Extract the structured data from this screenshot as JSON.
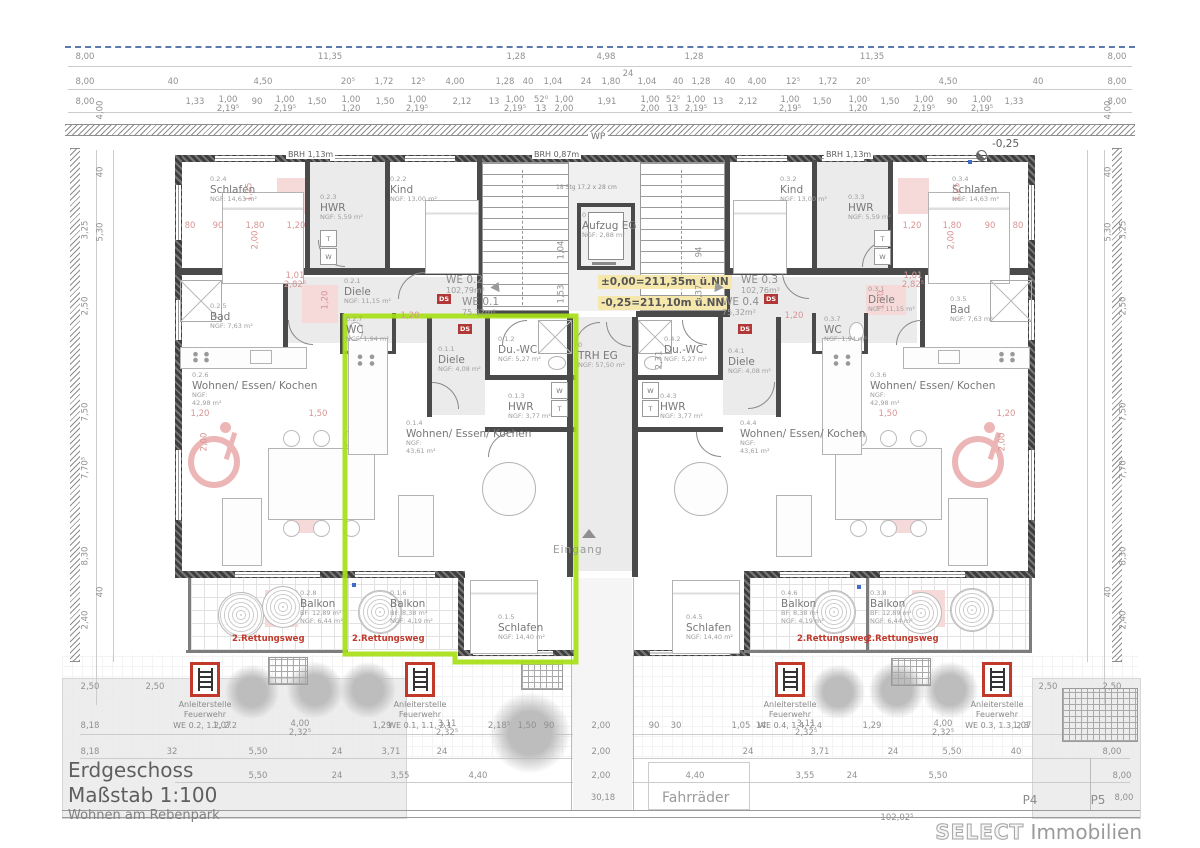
{
  "title": {
    "line1": "Erdgeschoss",
    "line2": "Maßstab 1:100",
    "line3": "Wohnen am Rebenpark"
  },
  "brand": {
    "name": "SELECT",
    "suffix": "Immobilien"
  },
  "labels": {
    "escape": "2.Rettungsweg",
    "ds": "DS",
    "wp": "WP",
    "brh_a": "BRH 1,13m",
    "brh_b": "BRH 0,87m",
    "brh_c": "BRH 1,13m",
    "eingang": "Eingang",
    "fahrraeder": "Fahrräder",
    "minus": "-0,25",
    "stair_note": "18 Stg 17,2 x 28 cm",
    "washer": "W",
    "dryer": "T"
  },
  "levels": {
    "l1": "±0,00=211,35m ü.NN",
    "l2": "-0,25=211,10m ü.NN"
  },
  "colors": {
    "highlight": "#a6e016",
    "escape_red": "#c0392b",
    "pink_fill": "#f6d9d9",
    "level_note_bg": "#f6e8ad",
    "property_line_blue": "#5b79ae"
  },
  "fire": {
    "l1": "Anleiterstelle",
    "l2": "Feuerwehr",
    "items": [
      {
        "we": "WE 0.2, 1.2, 2.2"
      },
      {
        "we": "WE 0.1, 1.1, 2.1"
      },
      {
        "we": "WE 0.4, 1.4, 2.4"
      },
      {
        "we": "WE 0.3, 1.3, 2.3"
      }
    ]
  },
  "units": [
    {
      "we": "WE 0.2",
      "area": "102,79m²",
      "x": 446,
      "y": 274
    },
    {
      "we": "WE 0.1",
      "area": "75,32m²",
      "x": 462,
      "y": 296
    },
    {
      "we": "WE 0.3",
      "area": "102,76m²",
      "x": 741,
      "y": 274
    },
    {
      "we": "WE 0.4",
      "area": "75,32m²",
      "x": 722,
      "y": 296
    }
  ],
  "rooms": [
    {
      "num": "0.2.4",
      "name": "Schlafen",
      "a": "NGF: 14,63 m²",
      "x": 210,
      "y": 176
    },
    {
      "num": "0.2.3",
      "name": "HWR",
      "a": "NGF: 5,59 m²",
      "x": 320,
      "y": 194
    },
    {
      "num": "0.2.2",
      "name": "Kind",
      "a": "NGF: 13,00 m²",
      "x": 390,
      "y": 176
    },
    {
      "num": "0.2.1",
      "name": "Diele",
      "a": "NGF: 11,15 m²",
      "x": 344,
      "y": 278
    },
    {
      "num": "0.2.5",
      "name": "Bad",
      "a": "NGF: 7,63 m²",
      "x": 210,
      "y": 303
    },
    {
      "num": "0.2.7",
      "name": "WC",
      "a": "NGF: 1,94 m²",
      "x": 346,
      "y": 316
    },
    {
      "num": "0.2.6",
      "name": "Wohnen/ Essen/ Kochen",
      "a": "NGF:",
      "a2": "42,98 m²",
      "x": 192,
      "y": 372
    },
    {
      "num": "0.2.8",
      "name": "Balkon",
      "a": "BF: 12,89 m²",
      "a2": "NGF: 6,44 m²",
      "x": 300,
      "y": 590
    },
    {
      "num": "0.1.1",
      "name": "Diele",
      "a": "NGF: 4,08 m²",
      "x": 438,
      "y": 346
    },
    {
      "num": "0.1.2",
      "name": "Du.-WC",
      "a": "NGF: 5,27 m²",
      "x": 498,
      "y": 336
    },
    {
      "num": "0.1.3",
      "name": "HWR",
      "a": "NGF: 3,77 m²",
      "x": 508,
      "y": 393
    },
    {
      "num": "0.1.4",
      "name": "Wohnen/ Essen/ Kochen",
      "a": "NGF:",
      "a2": "43,61 m²",
      "x": 406,
      "y": 420
    },
    {
      "num": "0.1.5",
      "name": "Schlafen",
      "a": "NGF: 14,40 m²",
      "x": 498,
      "y": 614
    },
    {
      "num": "0.1.6",
      "name": "Balkon",
      "a": "BF: 8,38 m²",
      "a2": "NGF: 4,19 m²",
      "x": 390,
      "y": 590
    },
    {
      "num": "0.4.1",
      "name": "Diele",
      "a": "NGF: 4,08 m²",
      "x": 728,
      "y": 348
    },
    {
      "num": "0.4.2",
      "name": "Du.-WC",
      "a": "NGF: 5,27 m²",
      "x": 664,
      "y": 336
    },
    {
      "num": "0.4.3",
      "name": "HWR",
      "a": "NGF: 3,77 m²",
      "x": 660,
      "y": 393
    },
    {
      "num": "0.4.4",
      "name": "Wohnen/ Essen/ Kochen",
      "a": "NGF:",
      "a2": "43,61 m²",
      "x": 740,
      "y": 420
    },
    {
      "num": "0.4.5",
      "name": "Schlafen",
      "a": "NGF: 14,40 m²",
      "x": 686,
      "y": 614
    },
    {
      "num": "0.4.6",
      "name": "Balkon",
      "a": "BF: 8,38 m²",
      "a2": "NGF: 4,19 m²",
      "x": 781,
      "y": 590
    },
    {
      "num": "0.3.2",
      "name": "Kind",
      "a": "NGF: 13,00 m²",
      "x": 780,
      "y": 176
    },
    {
      "num": "0.3.3",
      "name": "HWR",
      "a": "NGF: 5,59 m²",
      "x": 848,
      "y": 194
    },
    {
      "num": "0.3.4",
      "name": "Schlafen",
      "a": "NGF: 14,63 m²",
      "x": 952,
      "y": 176
    },
    {
      "num": "0.3.1",
      "name": "Diele",
      "a": "NGF: 11,15 m²",
      "x": 868,
      "y": 286
    },
    {
      "num": "0.3.5",
      "name": "Bad",
      "a": "NGF: 7,63 m²",
      "x": 950,
      "y": 296
    },
    {
      "num": "0.3.7",
      "name": "WC",
      "a": "NGF: 1,94 m²",
      "x": 824,
      "y": 316
    },
    {
      "num": "0.3.6",
      "name": "Wohnen/ Essen/ Kochen",
      "a": "NGF:",
      "a2": "42,98 m²",
      "x": 870,
      "y": 372
    },
    {
      "num": "0.3.8",
      "name": "Balkon",
      "a": "BF: 12,89 m²",
      "a2": "NGF: 6,44 m²",
      "x": 870,
      "y": 590
    },
    {
      "num": "0",
      "name": "Aufzug EG",
      "a": "NGF: 2,88 m²",
      "x": 582,
      "y": 212
    },
    {
      "num": "0",
      "name": "TRH EG",
      "a": "NGF: 57,50 m²",
      "x": 578,
      "y": 342
    }
  ],
  "dims": {
    "rows": [
      {
        "y": 53,
        "items": [
          {
            "t": "8,00",
            "x": 85
          },
          {
            "t": "11,35",
            "x": 330
          },
          {
            "t": "1,28",
            "x": 516
          },
          {
            "t": "4,98",
            "x": 606
          },
          {
            "t": "1,28",
            "x": 694
          },
          {
            "t": "11,35",
            "x": 872
          },
          {
            "t": "8,00",
            "x": 1117
          }
        ]
      },
      {
        "y": 70,
        "items": [
          {
            "t": "24",
            "x": 628
          }
        ]
      },
      {
        "y": 78,
        "items": [
          {
            "t": "8,00",
            "x": 85
          },
          {
            "t": "40",
            "x": 173
          },
          {
            "t": "4,50",
            "x": 263
          },
          {
            "t": "20⁵",
            "x": 348
          },
          {
            "t": "1,72",
            "x": 384
          },
          {
            "t": "12⁵",
            "x": 418
          },
          {
            "t": "4,00",
            "x": 455
          },
          {
            "t": "1,28",
            "x": 505
          },
          {
            "t": "40",
            "x": 528
          },
          {
            "t": "1,04",
            "x": 553
          },
          {
            "t": "24",
            "x": 586
          },
          {
            "t": "1,80",
            "x": 611
          },
          {
            "t": "1,04",
            "x": 647
          },
          {
            "t": "40",
            "x": 678
          },
          {
            "t": "1,28",
            "x": 701
          },
          {
            "t": "40",
            "x": 730
          },
          {
            "t": "4,00",
            "x": 757
          },
          {
            "t": "12⁵",
            "x": 793
          },
          {
            "t": "1,72",
            "x": 828
          },
          {
            "t": "20⁵",
            "x": 863
          },
          {
            "t": "4,50",
            "x": 948
          },
          {
            "t": "40",
            "x": 1038
          },
          {
            "t": "8,00",
            "x": 1117
          }
        ]
      },
      {
        "y": 98,
        "items": [
          {
            "t": "8,00",
            "x": 85
          },
          {
            "t": "1,33",
            "x": 195
          },
          {
            "t": "90",
            "x": 257
          },
          {
            "t": "1,50",
            "x": 317
          },
          {
            "t": "1,50",
            "x": 385
          },
          {
            "t": "2,12",
            "x": 462
          },
          {
            "t": "13",
            "x": 494
          },
          {
            "t": "1,91",
            "x": 607
          },
          {
            "t": "13",
            "x": 718
          },
          {
            "t": "2,12",
            "x": 748
          },
          {
            "t": "1,50",
            "x": 822
          },
          {
            "t": "1,50",
            "x": 890
          },
          {
            "t": "90",
            "x": 952
          },
          {
            "t": "1,33",
            "x": 1014
          },
          {
            "t": "8,00",
            "x": 1117
          }
        ]
      },
      {
        "y": 96,
        "items": [
          {
            "t": "1,00",
            "b": "2,19⁵",
            "x": 228
          },
          {
            "t": "1,00",
            "b": "2,19⁵",
            "x": 285
          },
          {
            "t": "1,00",
            "b": "1,20",
            "x": 351
          },
          {
            "t": "1,00",
            "b": "2,19⁵",
            "x": 417
          },
          {
            "t": "1,00",
            "b": "2,19⁵",
            "x": 515
          },
          {
            "t": "52⁰",
            "b": "13",
            "x": 541
          },
          {
            "t": "1,00",
            "b": "2,00",
            "x": 564
          },
          {
            "t": "1,00",
            "b": "2,00",
            "x": 650
          },
          {
            "t": "52⁵",
            "b": "13",
            "x": 673
          },
          {
            "t": "1,00",
            "b": "2,19⁵",
            "x": 696
          },
          {
            "t": "1,00",
            "b": "2,19⁵",
            "x": 790
          },
          {
            "t": "1,00",
            "b": "1,20",
            "x": 858
          },
          {
            "t": "1,00",
            "b": "2,19⁵",
            "x": 924
          },
          {
            "t": "1,00",
            "b": "2,19⁵",
            "x": 982
          }
        ]
      },
      {
        "y": 722,
        "items": [
          {
            "t": "8,18",
            "x": 90
          },
          {
            "t": "1,07",
            "x": 222
          },
          {
            "t": "1,29",
            "x": 382
          },
          {
            "t": "2,18⁵",
            "x": 499
          },
          {
            "t": "1,50",
            "x": 527
          },
          {
            "t": "90",
            "x": 549
          },
          {
            "t": "2,00",
            "x": 601
          },
          {
            "t": "90",
            "x": 654
          },
          {
            "t": "30",
            "x": 676
          },
          {
            "t": "1,05",
            "x": 741
          },
          {
            "t": "14",
            "x": 761
          },
          {
            "t": "1,29",
            "x": 872
          },
          {
            "t": "1,07",
            "x": 1022
          }
        ]
      },
      {
        "y": 720,
        "items": [
          {
            "t": "4,00",
            "b": "2,32⁵",
            "x": 300
          },
          {
            "t": "3,11",
            "b": "2,32⁵",
            "x": 447
          },
          {
            "t": "3,11",
            "b": "2,32⁵",
            "x": 806
          },
          {
            "t": "4,00",
            "b": "2,32⁵",
            "x": 943
          }
        ]
      },
      {
        "y": 748,
        "items": [
          {
            "t": "8,18",
            "x": 90
          },
          {
            "t": "32",
            "x": 172
          },
          {
            "t": "5,50",
            "x": 258
          },
          {
            "t": "24",
            "x": 337
          },
          {
            "t": "3,71",
            "x": 391
          },
          {
            "t": "24",
            "x": 442
          },
          {
            "t": "2,00",
            "x": 601
          },
          {
            "t": "24",
            "x": 748
          },
          {
            "t": "3,71",
            "x": 820
          },
          {
            "t": "24",
            "x": 893
          },
          {
            "t": "5,50",
            "x": 952
          },
          {
            "t": "40",
            "x": 1016
          },
          {
            "t": "8,00",
            "x": 1112
          }
        ]
      },
      {
        "y": 772,
        "items": [
          {
            "t": "5,50",
            "x": 258
          },
          {
            "t": "24",
            "x": 337
          },
          {
            "t": "3,55",
            "x": 400
          },
          {
            "t": "4,40",
            "x": 478
          },
          {
            "t": "2,00",
            "x": 601
          },
          {
            "t": "4,40",
            "x": 695
          },
          {
            "t": "3,55",
            "x": 805
          },
          {
            "t": "24",
            "x": 852
          },
          {
            "t": "5,50",
            "x": 938
          },
          {
            "t": "8,00",
            "x": 1122
          }
        ]
      },
      {
        "y": 794,
        "items": [
          {
            "t": "30,18",
            "x": 603
          },
          {
            "t": "P4",
            "x": 1030,
            "c": "plabel"
          },
          {
            "t": "P5",
            "x": 1098,
            "c": "plabel"
          },
          {
            "t": "8,00",
            "x": 1124
          }
        ]
      },
      {
        "y": 814,
        "items": [
          {
            "t": "102,02⁵",
            "x": 897
          }
        ]
      },
      {
        "y": 683,
        "items": [
          {
            "t": "2,50",
            "x": 90
          },
          {
            "t": "2,50",
            "x": 155
          },
          {
            "t": "2,50",
            "x": 1048
          },
          {
            "t": "2,50",
            "x": 1112
          }
        ]
      },
      {
        "y": 222,
        "items": [
          {
            "t": "80",
            "x": 190,
            "c": "p"
          },
          {
            "t": "90",
            "x": 218,
            "c": "p"
          },
          {
            "t": "1,80",
            "x": 255,
            "c": "p"
          },
          {
            "t": "1,20",
            "x": 296,
            "c": "p"
          },
          {
            "t": "1,20",
            "x": 912,
            "c": "p"
          },
          {
            "t": "1,80",
            "x": 952,
            "c": "p"
          },
          {
            "t": "90",
            "x": 990,
            "c": "p"
          },
          {
            "t": "80",
            "x": 1018,
            "c": "p"
          }
        ]
      },
      {
        "y": 312,
        "items": [
          {
            "t": "1,20",
            "x": 410,
            "c": "p"
          },
          {
            "t": "1,20",
            "x": 794,
            "c": "p"
          }
        ]
      },
      {
        "y": 410,
        "items": [
          {
            "t": "1,20",
            "x": 200,
            "c": "p"
          },
          {
            "t": "1,50",
            "x": 318,
            "c": "p"
          },
          {
            "t": "1,50",
            "x": 888,
            "c": "p"
          },
          {
            "t": "1,20",
            "x": 1006,
            "c": "p"
          }
        ]
      },
      {
        "y": 272,
        "items": [
          {
            "t": "1,01",
            "b": "2,82⁵",
            "x": 295,
            "c": "p"
          },
          {
            "t": "1,01",
            "b": "2,82⁵",
            "x": 913,
            "c": "p"
          }
        ]
      }
    ],
    "vert": [
      {
        "t": "4,00",
        "x": 101,
        "y": 110
      },
      {
        "t": "40",
        "x": 101,
        "y": 172
      },
      {
        "t": "3,25",
        "x": 86,
        "y": 230
      },
      {
        "t": "5,30",
        "x": 101,
        "y": 232
      },
      {
        "t": "2,50",
        "x": 86,
        "y": 306
      },
      {
        "t": "7,50",
        "x": 86,
        "y": 412
      },
      {
        "t": "7,70⁵",
        "x": 86,
        "y": 468
      },
      {
        "t": "8,30",
        "x": 86,
        "y": 556
      },
      {
        "t": "40",
        "x": 101,
        "y": 592
      },
      {
        "t": "2,40",
        "x": 86,
        "y": 620
      },
      {
        "t": "4,00",
        "x": 1109,
        "y": 110
      },
      {
        "t": "40",
        "x": 1109,
        "y": 172
      },
      {
        "t": "3,25",
        "x": 1124,
        "y": 230
      },
      {
        "t": "5,30",
        "x": 1109,
        "y": 232
      },
      {
        "t": "2,50",
        "x": 1124,
        "y": 306
      },
      {
        "t": "7,50",
        "x": 1124,
        "y": 412
      },
      {
        "t": "7,70⁵",
        "x": 1124,
        "y": 468
      },
      {
        "t": "8,30",
        "x": 1124,
        "y": 556
      },
      {
        "t": "40",
        "x": 1109,
        "y": 592
      },
      {
        "t": "2,40",
        "x": 1124,
        "y": 620
      },
      {
        "t": "1,04",
        "x": 562,
        "y": 250
      },
      {
        "t": "1,53",
        "x": 562,
        "y": 294
      },
      {
        "t": "94",
        "x": 700,
        "y": 252
      },
      {
        "t": "1,37",
        "x": 700,
        "y": 294
      },
      {
        "t": "2,31",
        "x": 660,
        "y": 360
      },
      {
        "t": "1,25",
        "x": 250,
        "y": 192,
        "c": "p"
      },
      {
        "t": "2,00",
        "x": 256,
        "y": 240,
        "c": "p"
      },
      {
        "t": "1,25",
        "x": 958,
        "y": 192,
        "c": "p"
      },
      {
        "t": "2,00",
        "x": 952,
        "y": 240,
        "c": "p"
      },
      {
        "t": "1,20",
        "x": 326,
        "y": 300,
        "c": "p"
      },
      {
        "t": "1,20",
        "x": 882,
        "y": 300,
        "c": "p"
      },
      {
        "t": "2,00",
        "x": 205,
        "y": 442,
        "c": "p"
      },
      {
        "t": "2,00",
        "x": 1003,
        "y": 442,
        "c": "p"
      }
    ]
  }
}
